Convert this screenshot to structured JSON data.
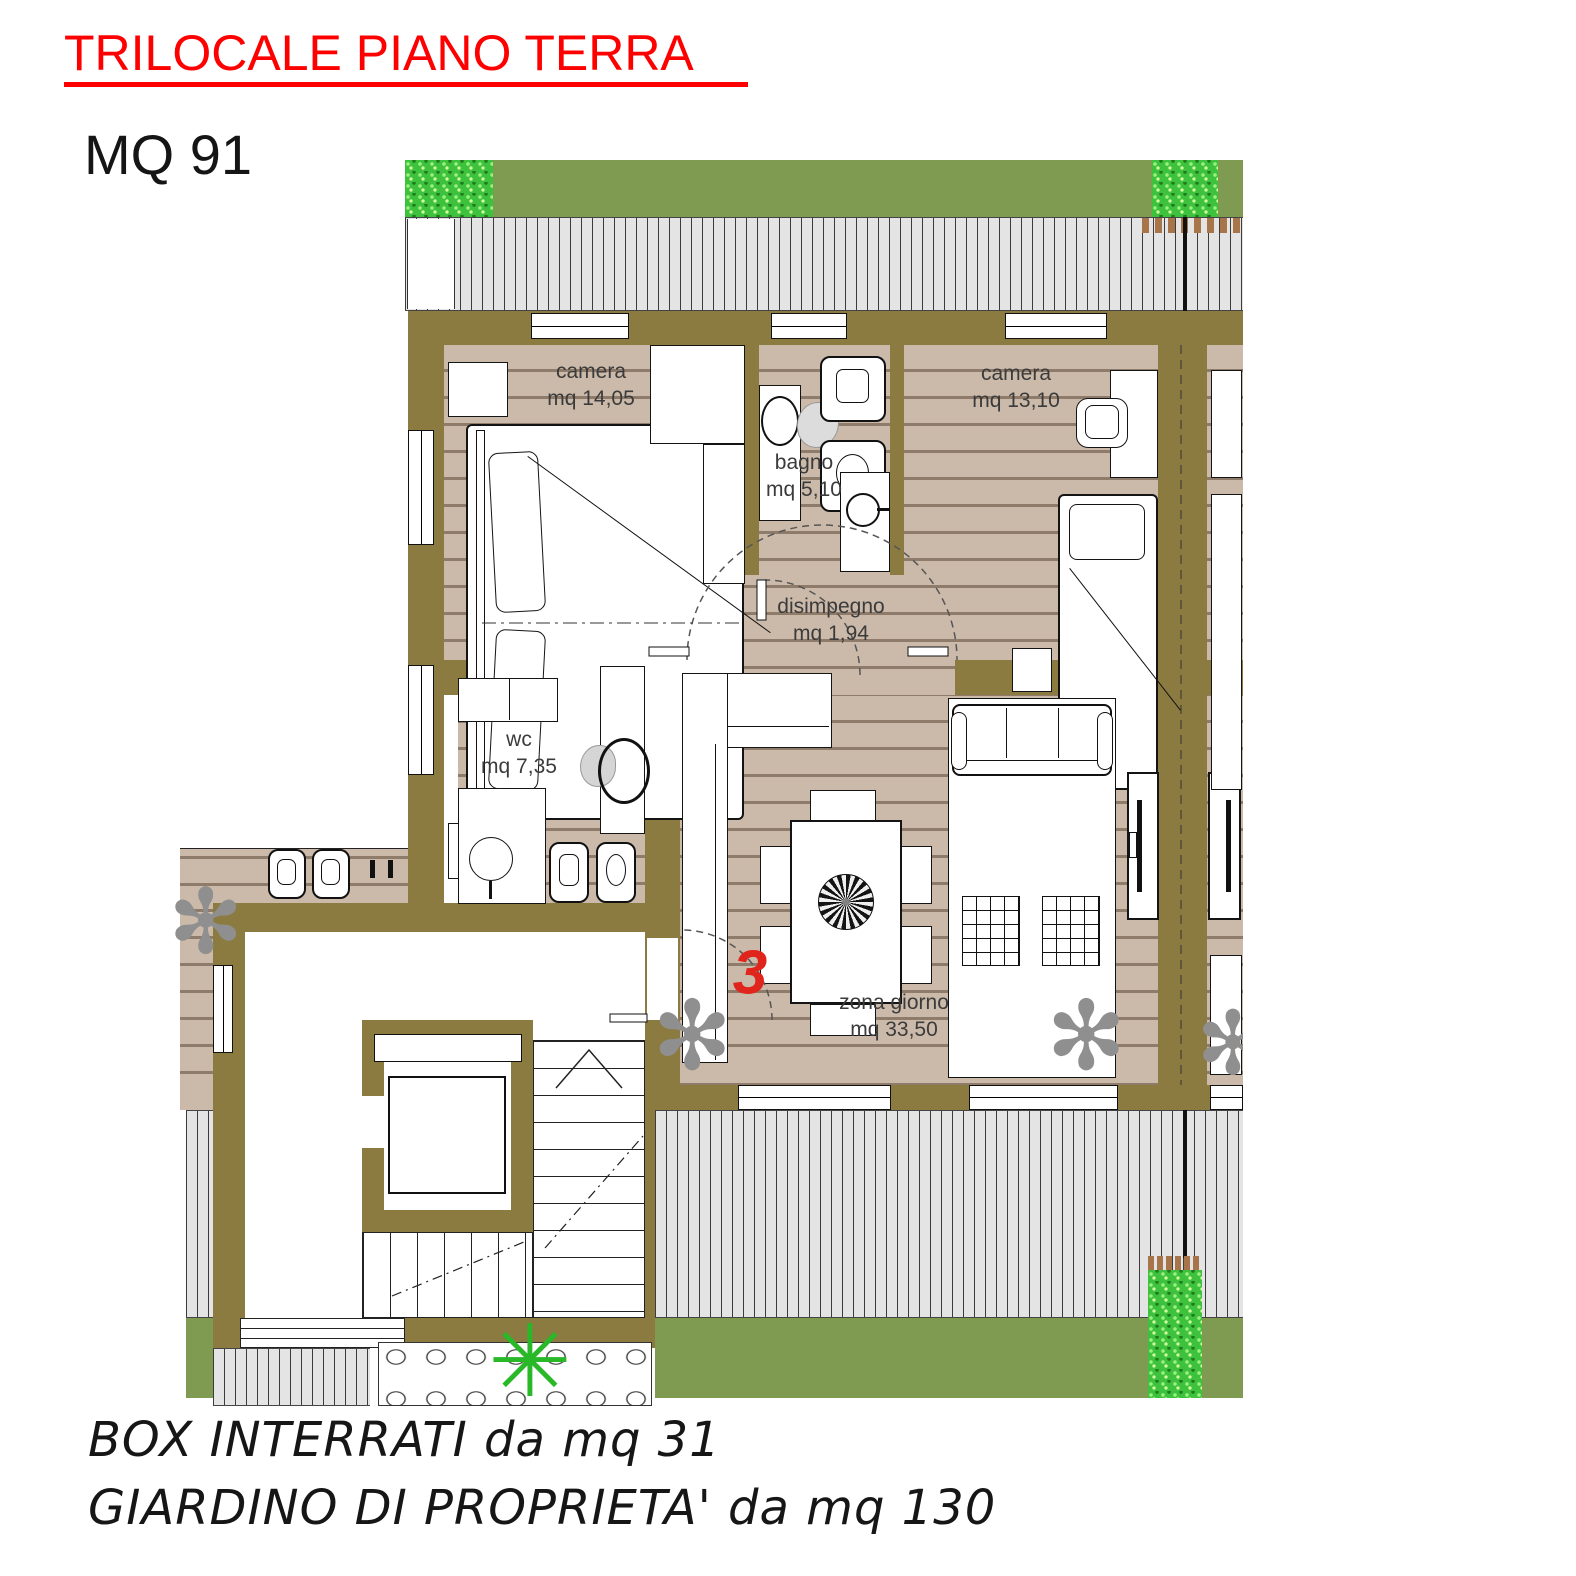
{
  "header": {
    "title": "TRILOCALE PIANO TERRA",
    "area": "MQ 91"
  },
  "rooms": [
    {
      "id": "camera1",
      "name": "camera",
      "size": "mq 14,05"
    },
    {
      "id": "bagno",
      "name": "bagno",
      "size": "mq 5,10"
    },
    {
      "id": "camera2",
      "name": "camera",
      "size": "mq 13,10"
    },
    {
      "id": "disimpegno",
      "name": "disimpegno",
      "size": "mq 1,94"
    },
    {
      "id": "wc",
      "name": "wc",
      "size": "mq 7,35"
    },
    {
      "id": "zona",
      "name": "zona giorno",
      "size": "mq 33,50"
    }
  ],
  "unit_number": "3",
  "footer": {
    "line1": "BOX INTERRATI da mq 31",
    "line2": "GIARDINO DI PROPRIETA' da mq 130"
  },
  "icons": {
    "plant_flower": "flower-plant-icon",
    "plant_palm": "palm-plant-icon"
  },
  "colors": {
    "title_red": "#FF0000",
    "unit_red": "#E0251C",
    "wall_olive": "#8C7B41",
    "floor_wood": "#CBBAA9",
    "plank_line": "#8E7B6A",
    "grass": "#7E9B51",
    "bush_green": "#3EC23E",
    "deck_gray": "#E4E4E4"
  }
}
